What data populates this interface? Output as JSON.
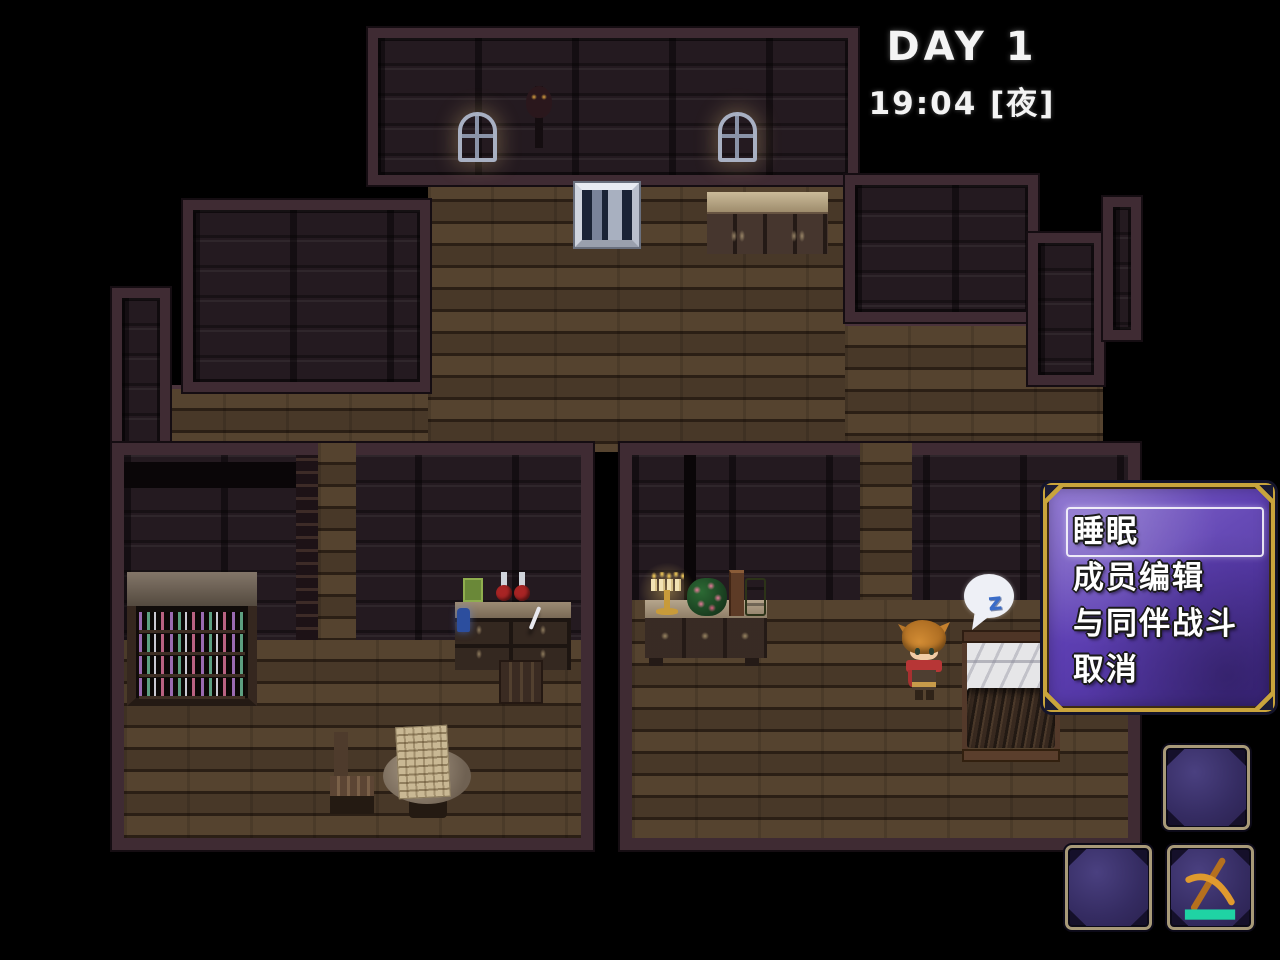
{
  "hud": {
    "day_label": "DAY 1",
    "time_label": "19:04 [夜]"
  },
  "action_menu": {
    "items": [
      {
        "label": "睡眠"
      },
      {
        "label": "成员编辑"
      },
      {
        "label": "与同伴战斗"
      },
      {
        "label": "取消"
      }
    ],
    "selected_index": 0,
    "colors": {
      "border_gold": "#c9a43c",
      "panel_top": "#8468cf",
      "panel_bottom": "#432a8e",
      "text": "#ffffff"
    }
  },
  "quick_slots": {
    "slots": [
      {
        "name": "slot-1",
        "icon": ""
      },
      {
        "name": "slot-2",
        "icon": ""
      },
      {
        "name": "slot-3",
        "icon": "pickaxe-icon",
        "bar_color": "#1fd3a4"
      }
    ],
    "colors": {
      "frame": "#a89a78",
      "fill": "#352c62"
    }
  },
  "scene": {
    "sleep_bubble_text": "z",
    "location": "wooden-house-interior-night"
  }
}
